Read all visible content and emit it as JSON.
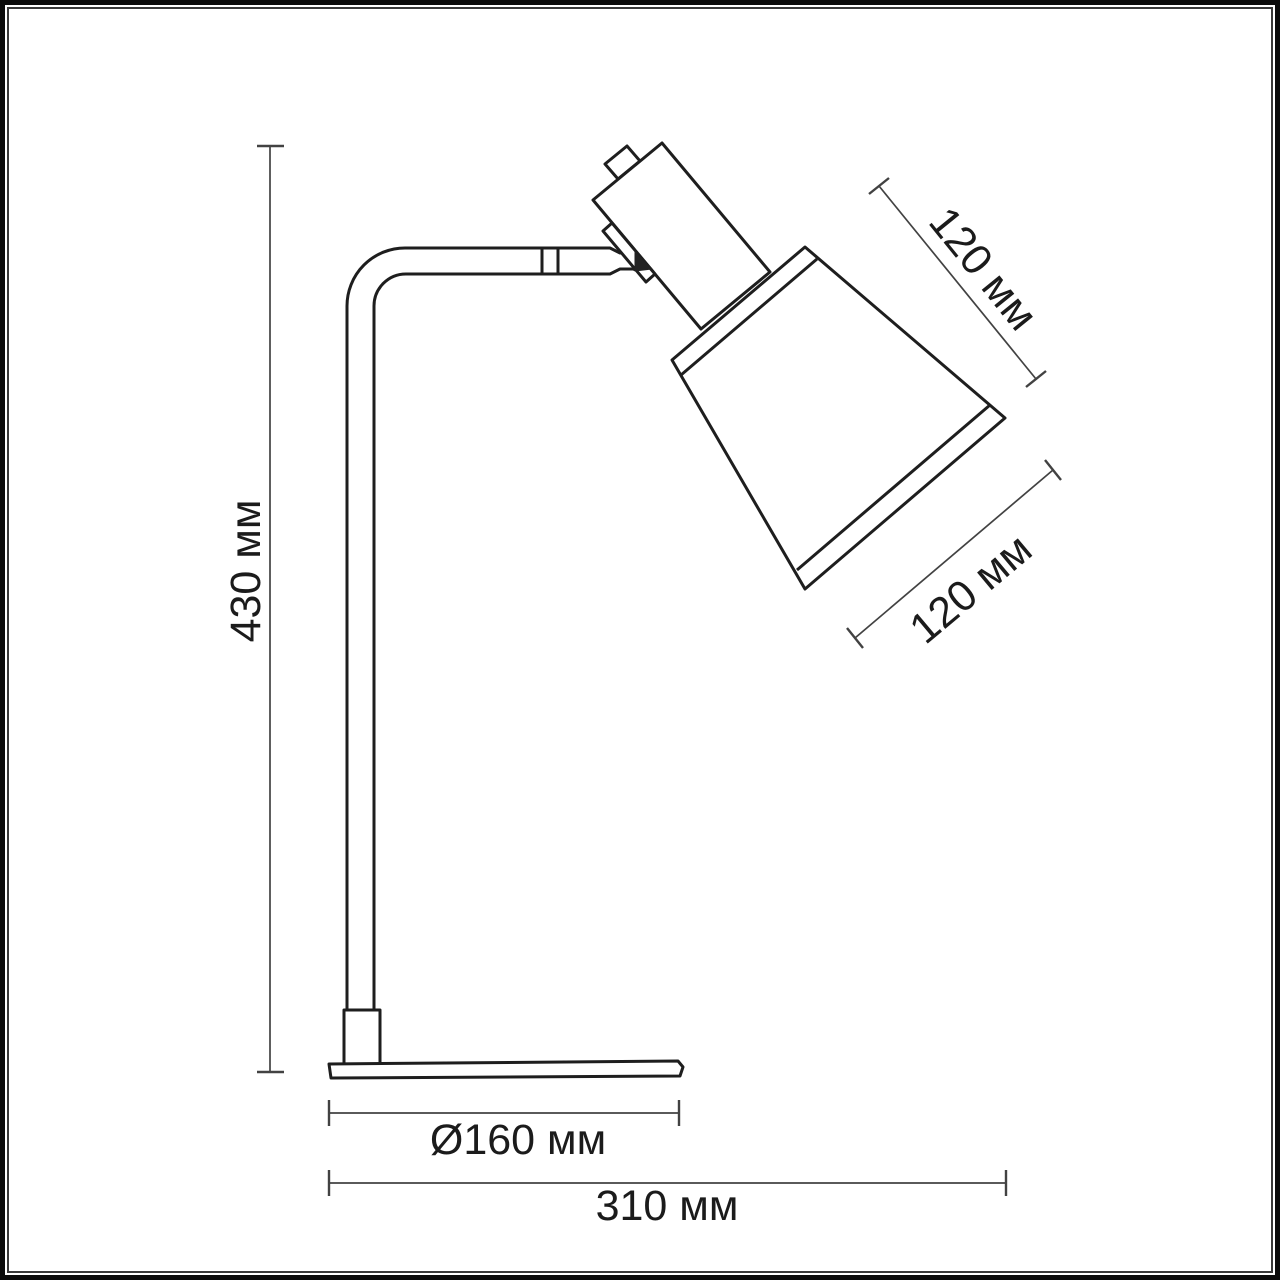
{
  "drawing": {
    "subject": "table lamp technical dimension drawing",
    "background_color": "#ffffff",
    "lamp_line_color": "#1e1e1e",
    "dimension_line_color": "#424242",
    "text_color": "#1b1b1b",
    "frame": {
      "outer_border_color": "#0b0b0b",
      "inner_border_color": "#3a3a3a"
    },
    "dims": {
      "height": {
        "label": "430 мм",
        "value": 430,
        "unit": "мм"
      },
      "shade_upper": {
        "label": "120 мм",
        "value": 120,
        "unit": "мм"
      },
      "shade_lower": {
        "label": "120 мм",
        "value": 120,
        "unit": "мм"
      },
      "base_diameter": {
        "label": "Ø160 мм",
        "value": 160,
        "unit": "мм"
      },
      "total_depth": {
        "label": "310 мм",
        "value": 310,
        "unit": "мм"
      }
    }
  }
}
